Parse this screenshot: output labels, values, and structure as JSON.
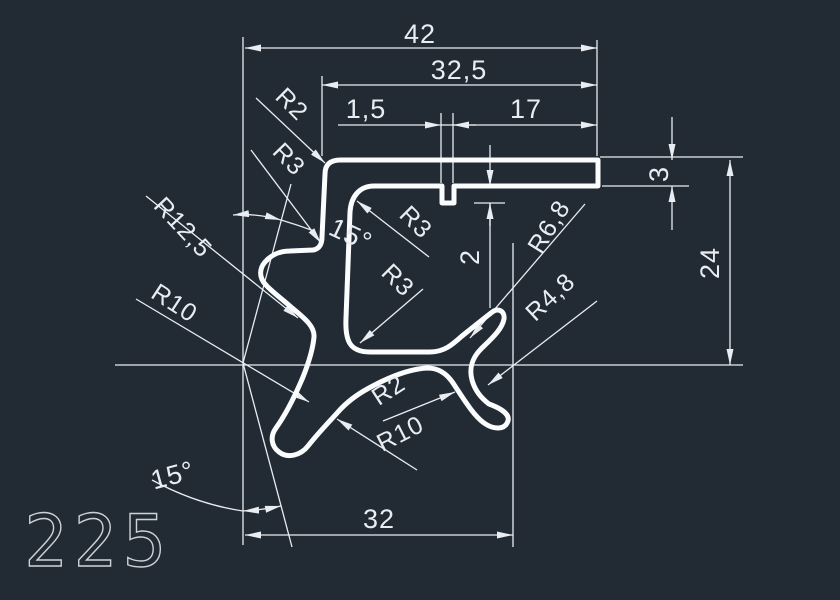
{
  "colors": {
    "background": "#222a34",
    "line": "#e9edf1",
    "profile": "#fbfcfd"
  },
  "part_label": "225",
  "dimensions": {
    "overall_width": "42",
    "upper_width": "32,5",
    "rib_width": "1,5",
    "right_width": "17",
    "arm_thickness": "3",
    "right_height": "24",
    "rib_depth": "2",
    "bottom_width": "32",
    "top_angle": "15°",
    "bottom_angle": "15°"
  },
  "radii": {
    "corner_top": "R2",
    "flange_top": "R3",
    "cavity_top": "R3",
    "cavity_bottom": "R3",
    "scoop": "R12,5",
    "leg": "R10",
    "hook_outer": "R6,8",
    "hook_inner": "R4,8",
    "web_fillet": "R2",
    "web_radius": "R10"
  }
}
